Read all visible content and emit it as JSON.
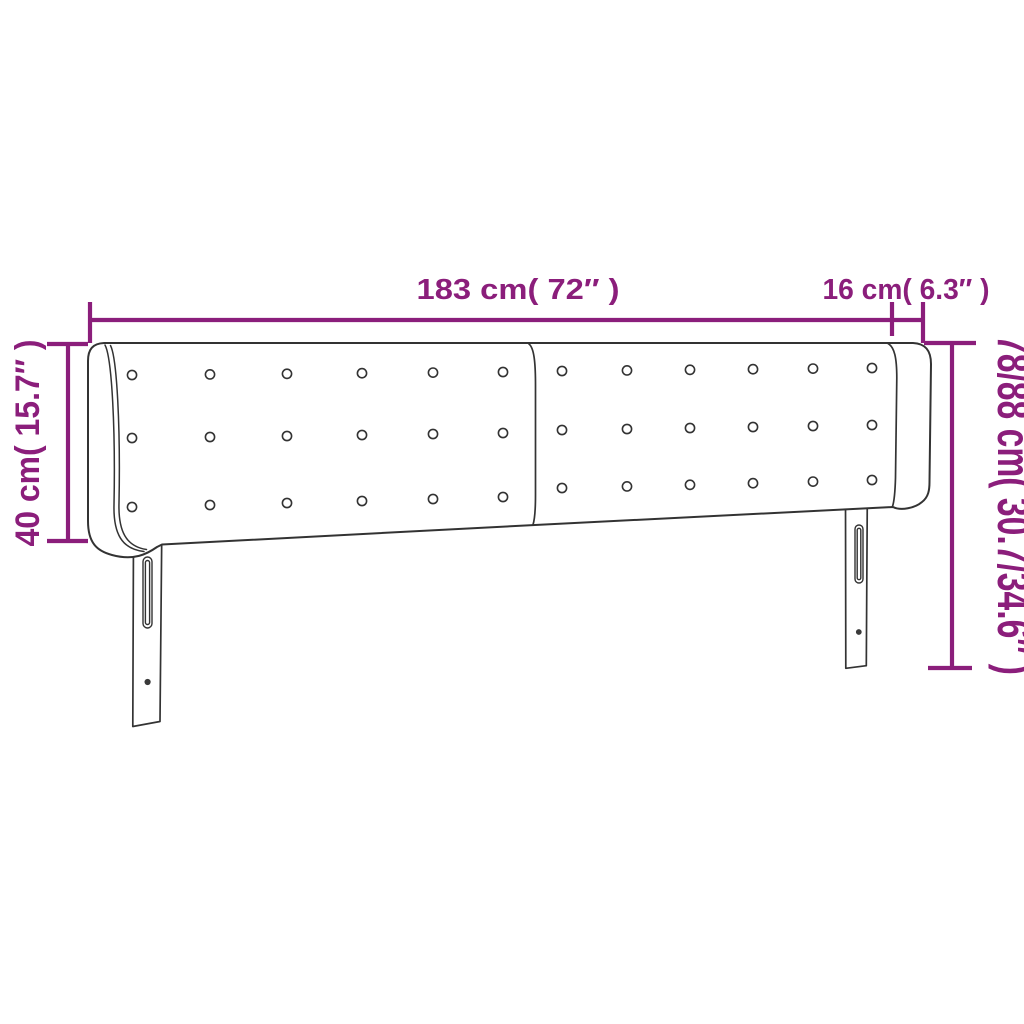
{
  "diagram": {
    "background_color": "#ffffff",
    "accent_color": "#8b1e7b",
    "outline_color": "#333333",
    "labels": {
      "total_width": "183 cm( 72″ )",
      "side_panel_depth": "16 cm( 6.3″ )",
      "headboard_height": "40 cm( 15.7″ )",
      "total_height": "78/88 cm( 30.7/34.6″ )"
    },
    "tufting": {
      "panels": 2,
      "rows_per_panel": 3,
      "columns_per_panel": 6,
      "total_buttons": 36
    }
  }
}
